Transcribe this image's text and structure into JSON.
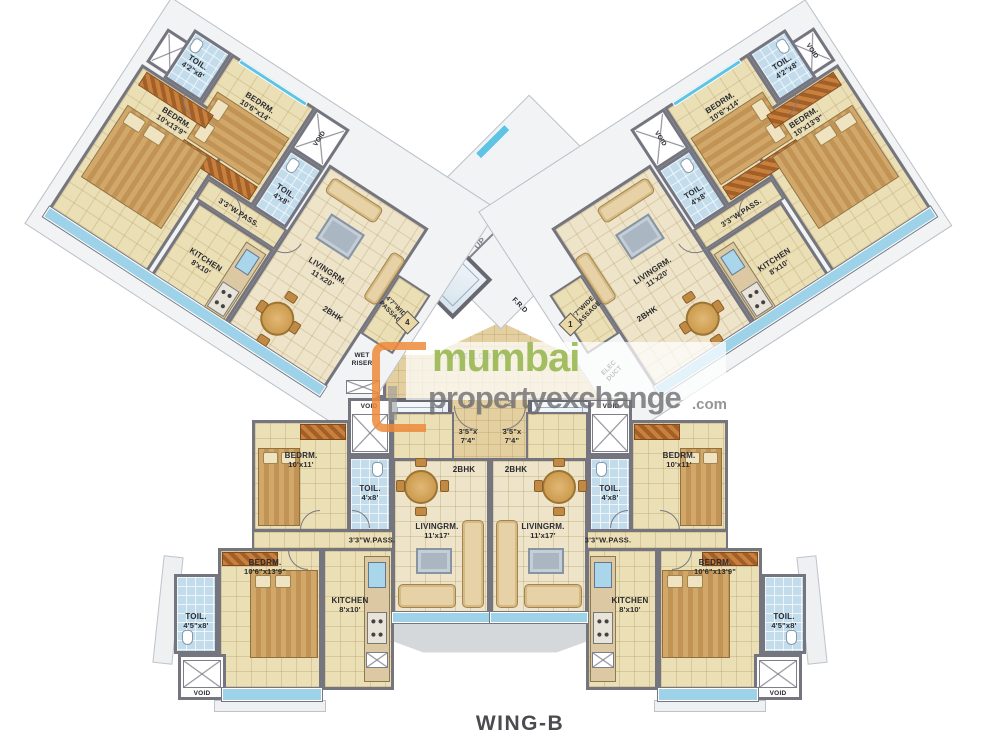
{
  "title": "WING-B",
  "watermark": {
    "brand": "mumbai",
    "brand2": "propertyexchange",
    "tld": ".com"
  },
  "core": {
    "up": "UP",
    "lift3": "LIFT-3",
    "lift2": "LIFT-2",
    "lift1": "LIFT-1",
    "lift_lobby": "LIFT LOBBY",
    "wet_riser": "WET\nRISER",
    "elec_duct": "ELEC\nDUCT",
    "frd": "F.R.D"
  },
  "flat_numbers": {
    "top_left": "4",
    "top_right": "1",
    "bottom_left": "3",
    "bottom_right": "2"
  },
  "units": {
    "top_left": {
      "bhk": "2BHK",
      "bedrm1": {
        "name": "BEDRM.",
        "dim": "10'6\"x14'"
      },
      "bedrm2": {
        "name": "BEDRM.",
        "dim": "10'x13'9\""
      },
      "toil1": {
        "name": "TOIL.",
        "dim": "4'2\"x8'"
      },
      "toil2": {
        "name": "TOIL.",
        "dim": "4'x8'"
      },
      "kitchen": {
        "name": "KITCHEN",
        "dim": "8'x10'"
      },
      "living": {
        "name": "LIVINGRM.",
        "dim": "11'x20'"
      },
      "pass": "3'3\"W.PASS.",
      "wide_pass": "4'7\"WIDE\nPASSAGE",
      "void": "VOID"
    },
    "top_right": {
      "bhk": "2BHK",
      "bedrm1": {
        "name": "BEDRM.",
        "dim": "10'6\"x14'"
      },
      "bedrm2": {
        "name": "BEDRM.",
        "dim": "10'x13'9\""
      },
      "toil1": {
        "name": "TOIL.",
        "dim": "4'2\"x8'"
      },
      "toil2": {
        "name": "TOIL.",
        "dim": "4'x8'"
      },
      "kitchen": {
        "name": "KITCHEN",
        "dim": "8'x10'"
      },
      "living": {
        "name": "LIVINGRM.",
        "dim": "11'x20'"
      },
      "pass": "3'3\"W.PASS.",
      "wide_pass": "4'7\"WIDE\nPASSAGE",
      "void": "VOID",
      "void_outer": "VOID"
    },
    "bottom_left": {
      "bhk": "2BHK",
      "entry_no": "3",
      "entry_dim": "3'5\"x\n7'4\"",
      "bedrm1": {
        "name": "BEDRM.",
        "dim": "10'x11'"
      },
      "bedrm2": {
        "name": "BEDRM.",
        "dim": "10'6\"x13'9\""
      },
      "toil1": {
        "name": "TOIL.",
        "dim": "4'x8'"
      },
      "toil2": {
        "name": "TOIL.",
        "dim": "4'5\"x8'"
      },
      "kitchen": {
        "name": "KITCHEN",
        "dim": "8'x10'"
      },
      "living": {
        "name": "LIVINGRM.",
        "dim": "11'x17'"
      },
      "pass": "3'3\"W.PASS.",
      "void_top": "VOID",
      "void_bottom": "VOID"
    },
    "bottom_right": {
      "bhk": "2BHK",
      "entry_no": "2",
      "entry_dim": "3'5\"x\n7'4\"",
      "bedrm1": {
        "name": "BEDRM.",
        "dim": "10'x11'"
      },
      "bedrm2": {
        "name": "BEDRM.",
        "dim": "10'6\"x13'9\""
      },
      "toil1": {
        "name": "TOIL.",
        "dim": "4'x8'"
      },
      "toil2": {
        "name": "TOIL.",
        "dim": "4'5\"x8'"
      },
      "kitchen": {
        "name": "KITCHEN",
        "dim": "8'x10'"
      },
      "living": {
        "name": "LIVINGRM.",
        "dim": "11'x17'"
      },
      "pass": "3'3\"W.PASS.",
      "void_top": "VOID",
      "void_bottom": "VOID"
    }
  }
}
